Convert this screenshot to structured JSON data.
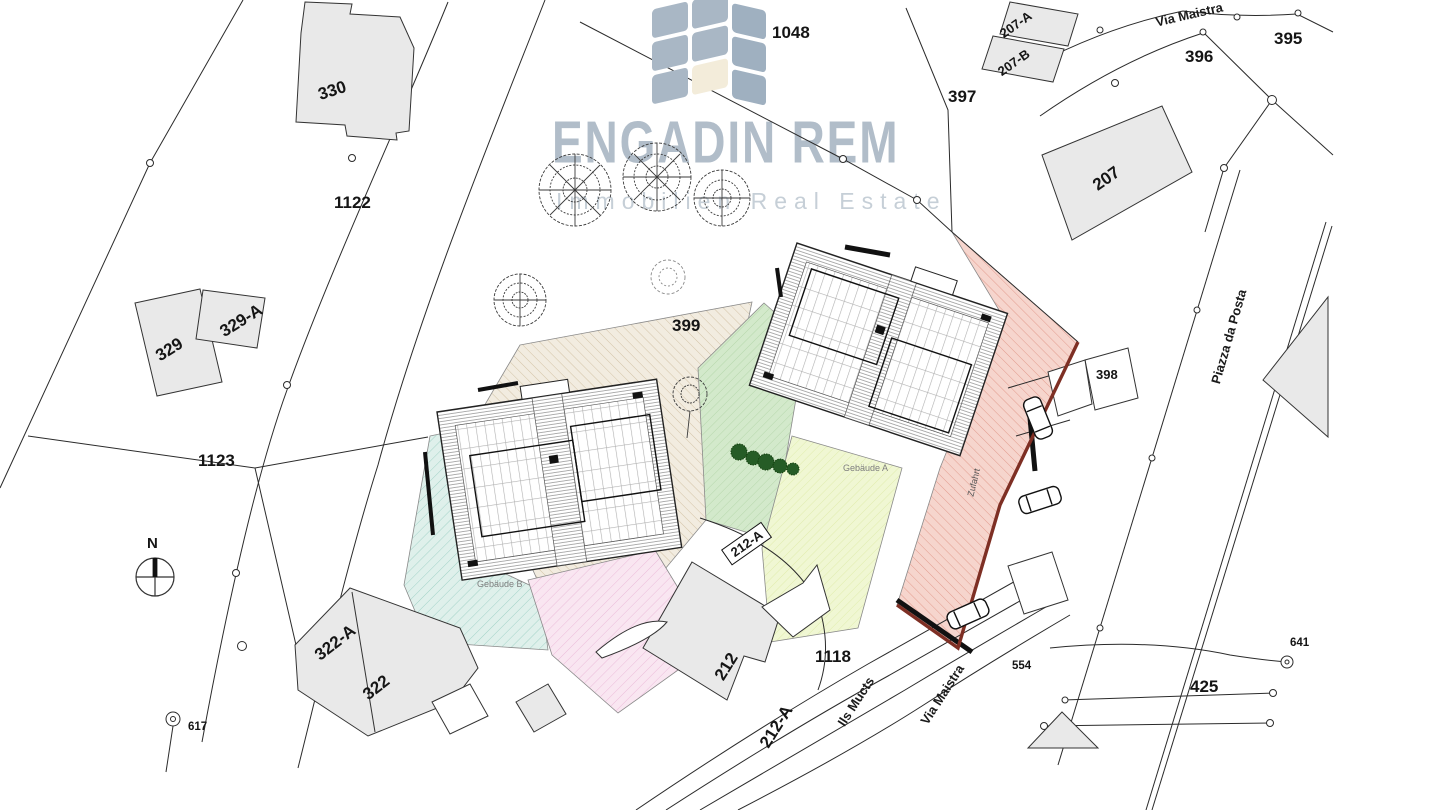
{
  "watermark": {
    "title": "ENGADIN REM",
    "subtitle": "Immobilien Real Estate"
  },
  "compass": {
    "north_label": "N"
  },
  "parcels": {
    "p1048": "1048",
    "p330": "330",
    "p1122": "1122",
    "p329a": "329-A",
    "p329": "329",
    "p1123": "1123",
    "p322a": "322-A",
    "p322": "322",
    "p617": "617",
    "p397": "397",
    "p207a": "207-A",
    "p207b": "207-B",
    "p207": "207",
    "p396": "396",
    "p395": "395",
    "p399": "399",
    "p398": "398",
    "p1118": "1118",
    "p212": "212",
    "p212a_boxed": "212-A",
    "p212a_lower": "212-A",
    "p425": "425",
    "p554": "554",
    "p641": "641"
  },
  "streets": {
    "via_maistra_top": "Via Maistra",
    "via_maistra_bottom": "Via Maistra",
    "piazza_da_posta": "Piazza da Posta",
    "ils_mucts": "Ils Mucts"
  },
  "annotations": {
    "building_a": "Gebäude A",
    "building_b": "Gebäude B",
    "driveway": "Zufahrt"
  },
  "colors": {
    "watermark_text": "#b1bdc9",
    "watermark_subtext": "#c6cfd7",
    "logo_tile": "#a9b7c5",
    "logo_tile_accent": "#f3ecda",
    "zone_cyan": "#cdeae4",
    "zone_pink": "#f6d9ec",
    "zone_tan": "#e9dfcf",
    "zone_green": "#cfe7c6",
    "zone_yellow": "#eef5cd",
    "zone_red": "#f2c7be",
    "zone_red_border": "#7e2f24",
    "building_fill": "#e9e9e9",
    "map_line": "#2b2b2b"
  }
}
